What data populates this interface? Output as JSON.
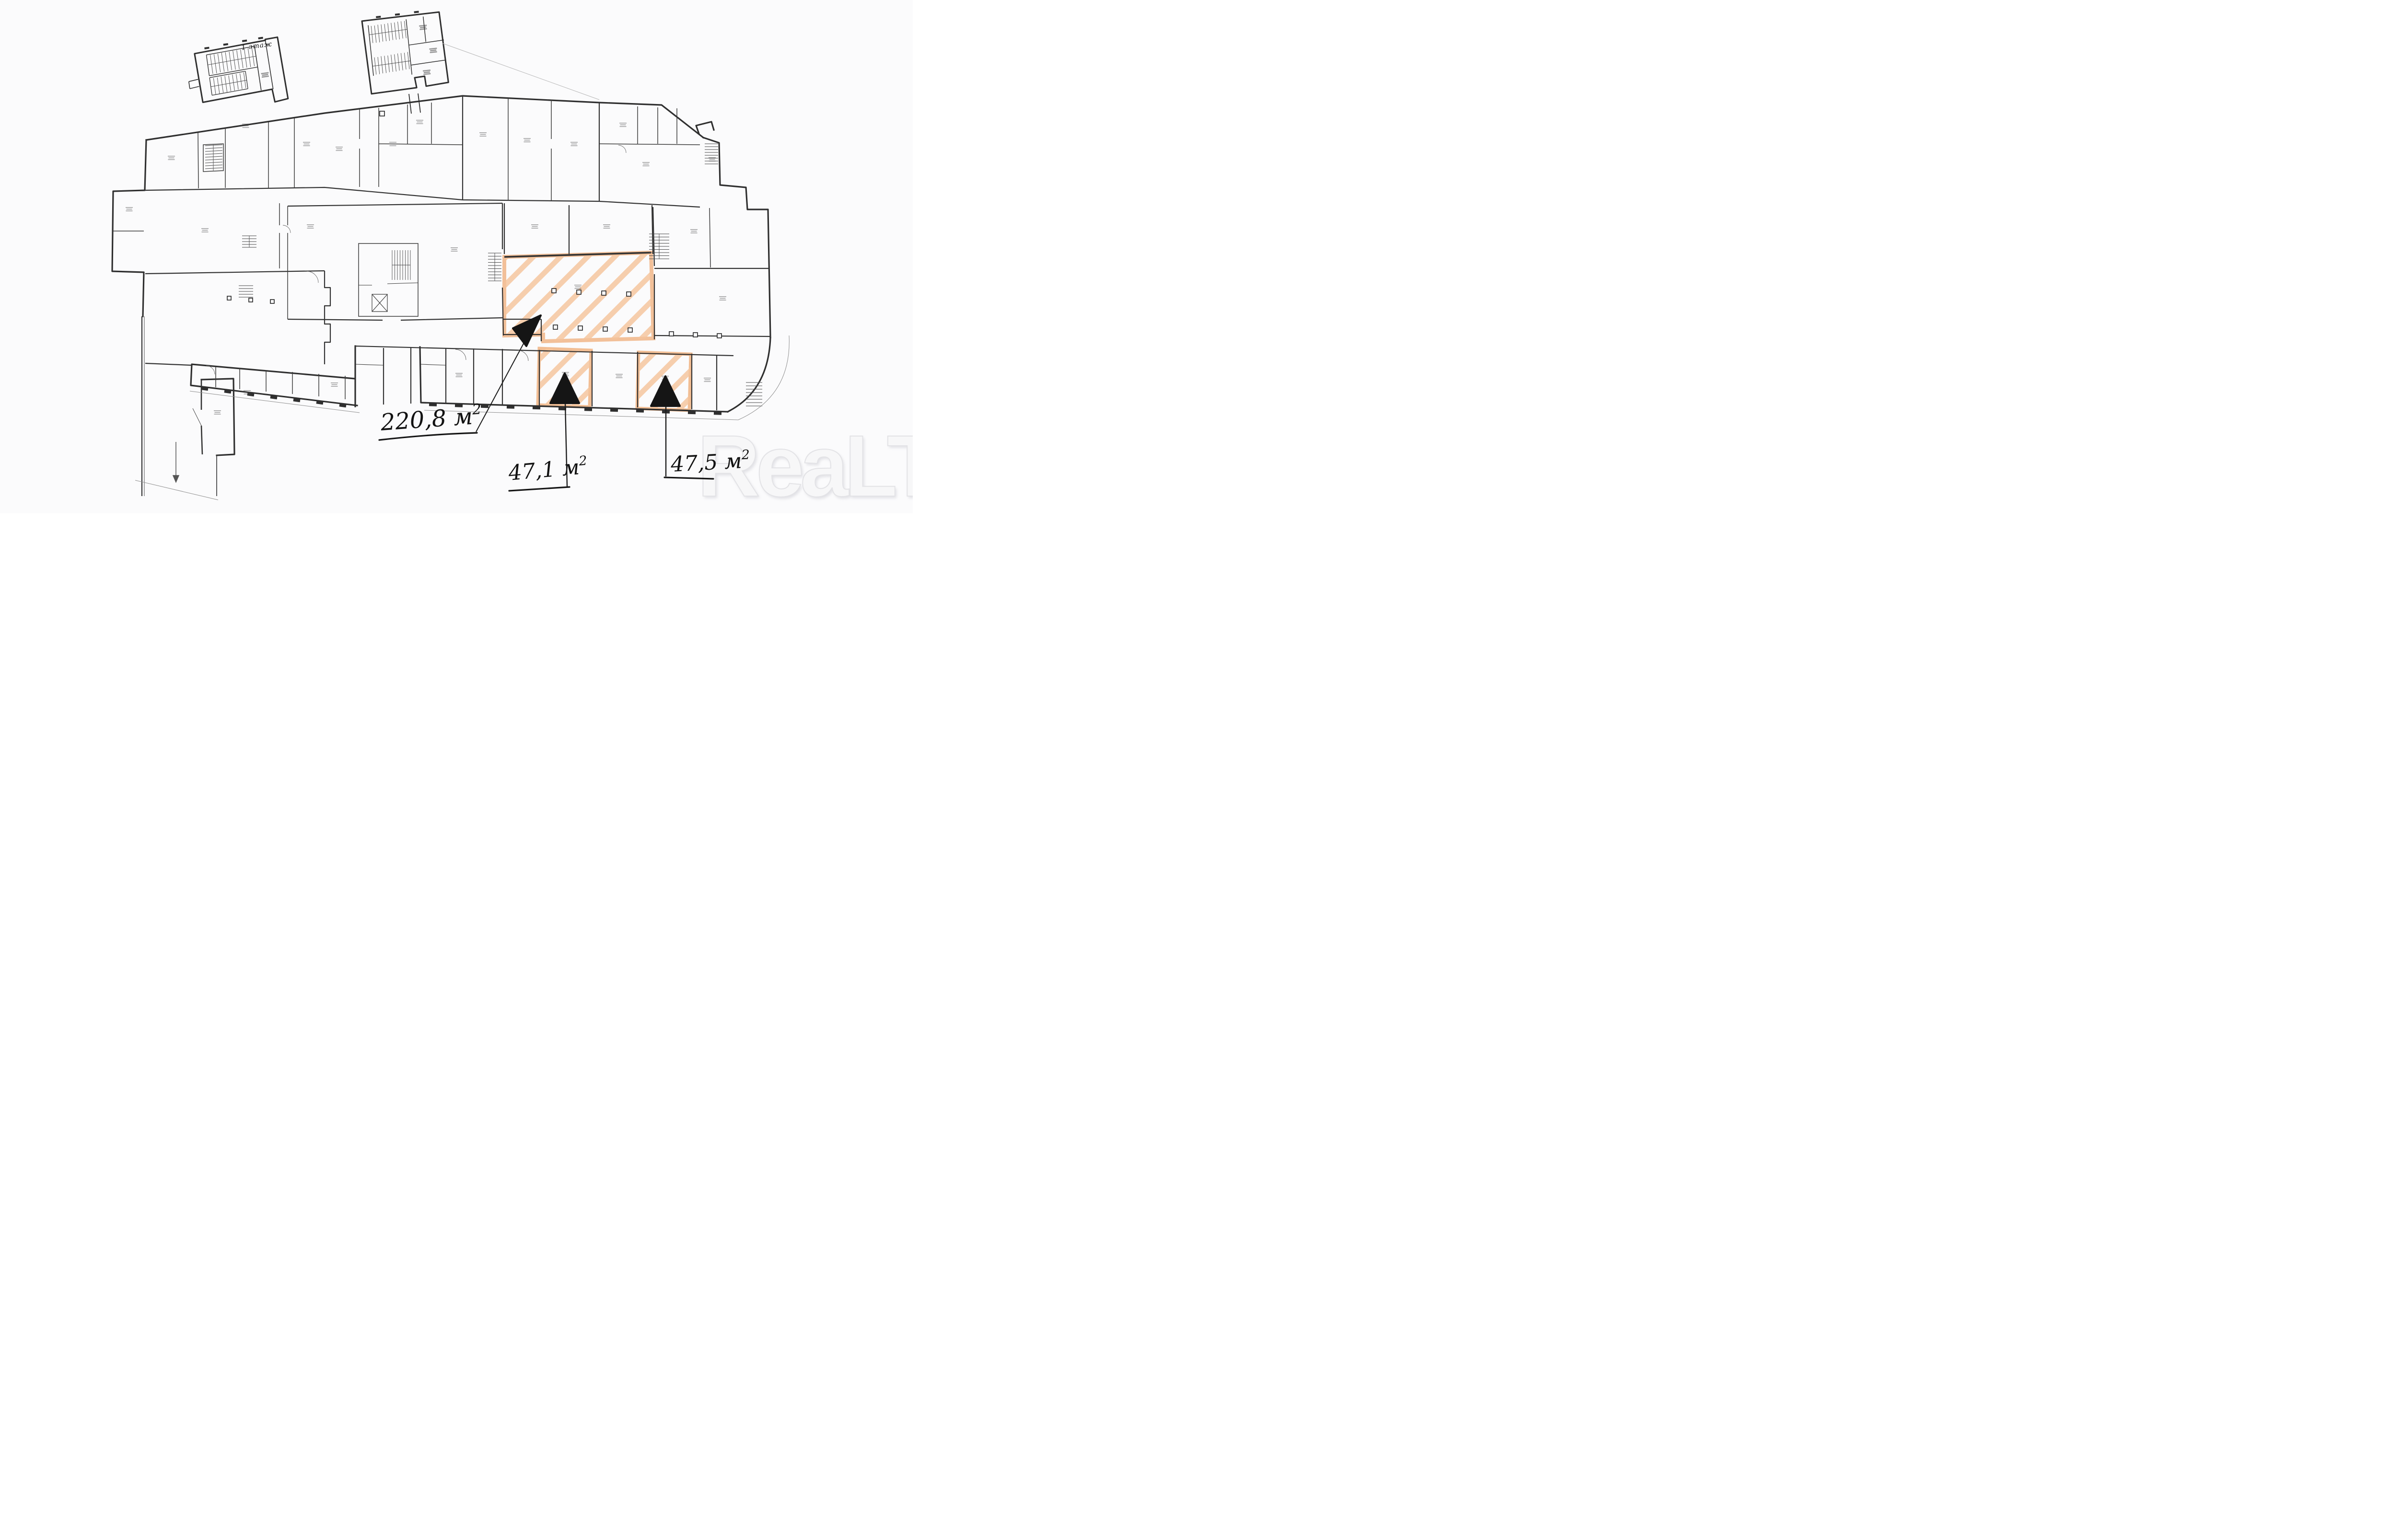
{
  "plan": {
    "floor_label": "1 этаж",
    "watermark_text": "ReaLT",
    "annotations": [
      {
        "id": "large-area",
        "text": "220,8 м",
        "sup": "2",
        "display": "220,8 м²"
      },
      {
        "id": "small-area-1",
        "text": "47,1 м",
        "sup": "2",
        "display": "47,1 м²"
      },
      {
        "id": "small-area-2",
        "text": "47,5 м",
        "sup": "2",
        "display": "47,5 м²"
      }
    ],
    "colors": {
      "paper": "#fbfbfc",
      "wall": "#2f2f2f",
      "highlight_stripe": "#f5c39a",
      "highlight_border": "#f1bd93",
      "marker": "#151515"
    }
  }
}
